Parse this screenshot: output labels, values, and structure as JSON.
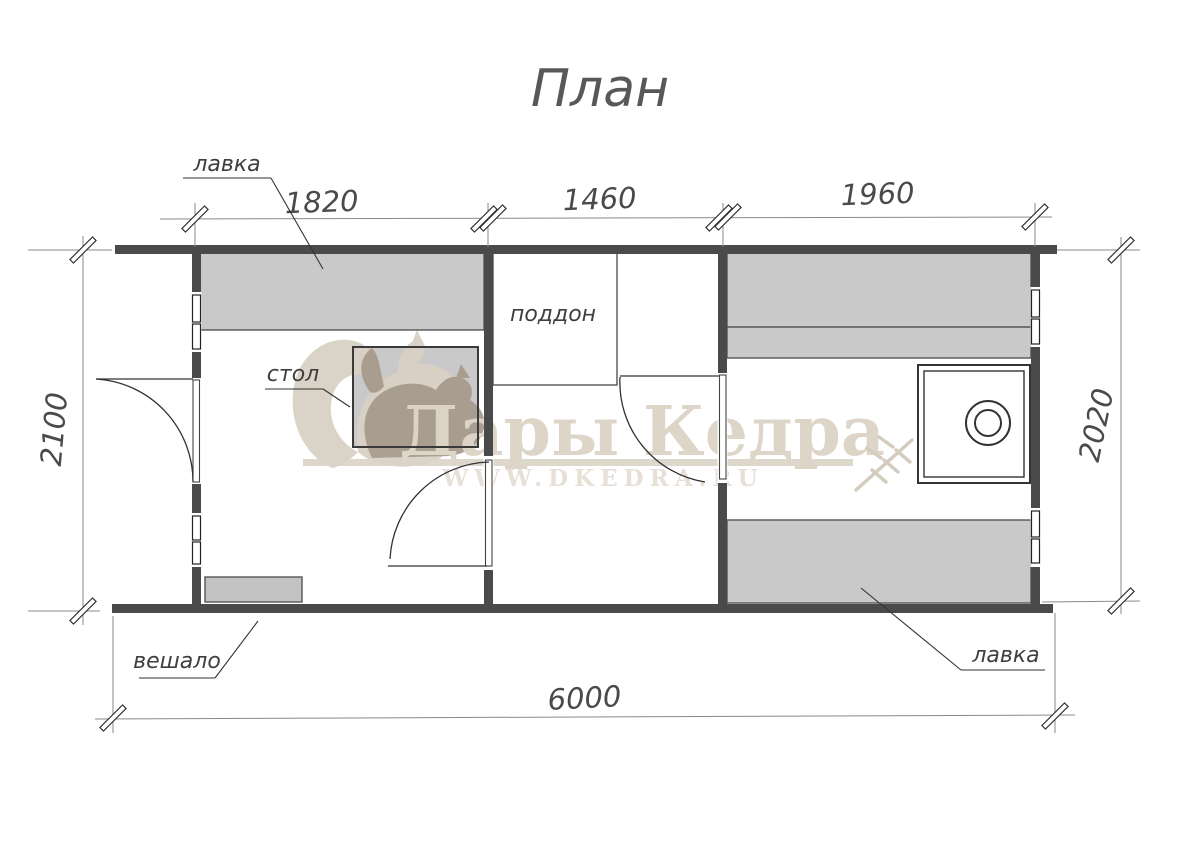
{
  "title": "План",
  "dimensions": {
    "top": [
      "1820",
      "1460",
      "1960"
    ],
    "left": "2100",
    "right": "2020",
    "bottom": "6000"
  },
  "labels": {
    "bench_top": "лавка",
    "table": "стол",
    "tray": "поддон",
    "hanger": "вешало",
    "bench_bottom": "лавка"
  },
  "watermark": {
    "brand": "Дары Кедра",
    "website": "WWW.DKEDRA.RU"
  },
  "colors": {
    "wall": "#4a4a4a",
    "bench_fill": "#c9c9c9",
    "furniture_border": "#555555",
    "thin_line": "#8a8a8a",
    "dark_line": "#333333",
    "watermark_light": "#d9d1c5",
    "watermark_dark": "#a89b8d",
    "watermark_text": "#dcd4c6"
  }
}
